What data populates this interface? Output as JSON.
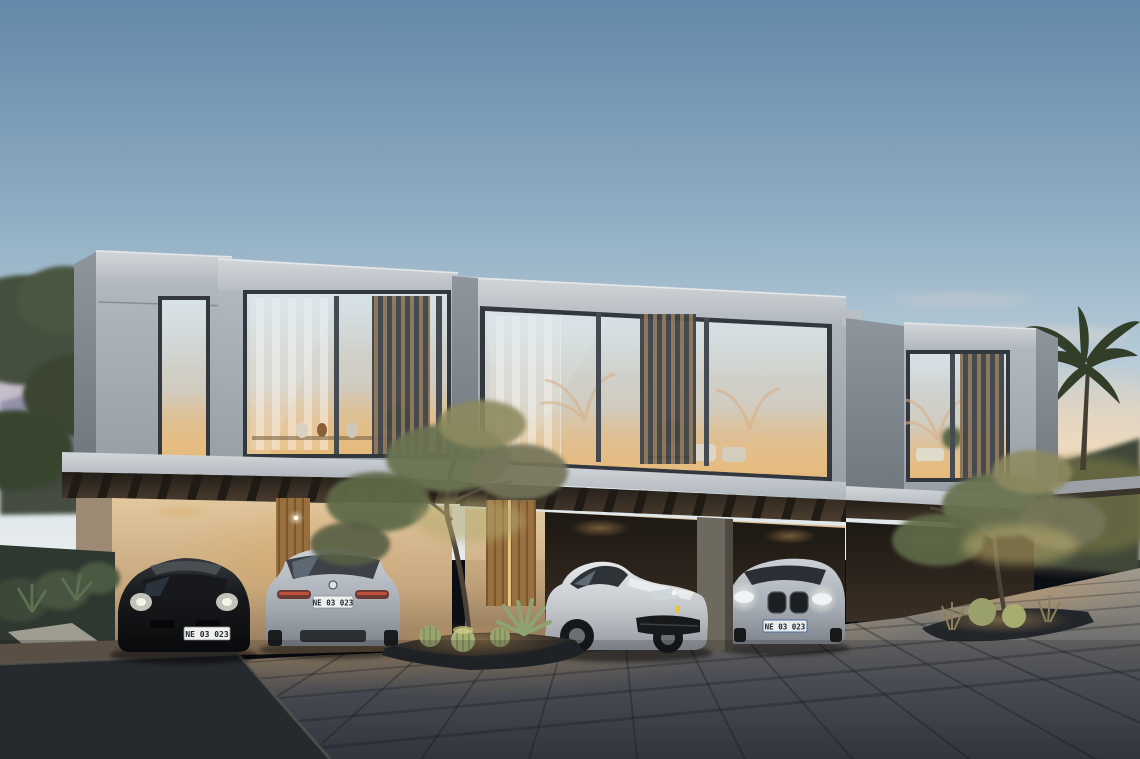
{
  "scene": {
    "subject": "Modern modular townhouse villas at dusk with carports",
    "time_of_day": "dusk",
    "units_visible": 3,
    "cars_visible": 4
  },
  "cars": [
    {
      "label": "black sports coupe",
      "view": "front",
      "plate": "NE 03 023"
    },
    {
      "label": "silver coupe",
      "view": "rear",
      "plate": "NE 03 023"
    },
    {
      "label": "white grand tourer",
      "view": "front three-quarter"
    },
    {
      "label": "silver coupe",
      "view": "front",
      "plate": "NE 03 023"
    }
  ],
  "palette": {
    "sky_top": "#6488a9",
    "sky_horizon": "#e9edee",
    "sunset_glow": "#f4d7b4",
    "dusk_pink": "#c9abb7",
    "concrete_light": "#bfc5cb",
    "concrete_shadow": "#7c848c",
    "interior_glow": "#e3c396",
    "wall_brick": "#cdb28c",
    "wood_door": "#a5793f",
    "foliage": "#5d6847",
    "foliage_lit": "#b0a76b",
    "pavement_dark": "#3a3f48",
    "pavement_warm": "#a39a8d",
    "car_black": "#141517",
    "car_silver": "#c4c9cf",
    "car_white": "#dcdee0",
    "plate_bg": "#f0f1ed"
  }
}
